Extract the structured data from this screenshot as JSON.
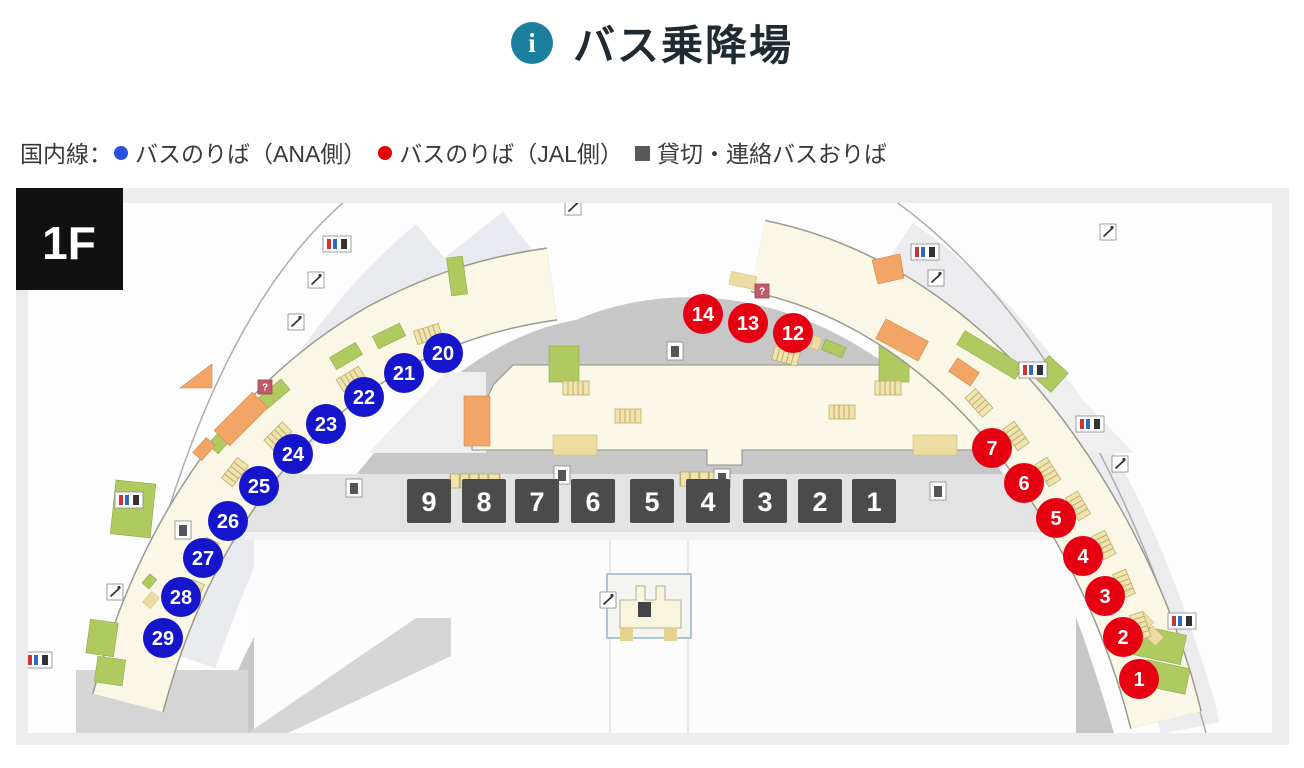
{
  "header": {
    "title": "バス乗降場",
    "icon_glyph": "i",
    "icon_color": "#1A7F9D",
    "title_color": "#1F2B33"
  },
  "legend": {
    "prefix": "国内線：",
    "items": [
      {
        "label": "バスのりば（ANA側）",
        "marker": "circle",
        "color": "#2B50DF"
      },
      {
        "label": "バスのりば（JAL側）",
        "marker": "circle",
        "color": "#E60000"
      },
      {
        "label": "貸切・連絡バスおりば",
        "marker": "square",
        "color": "#585858"
      }
    ]
  },
  "map": {
    "floor_label": "1F",
    "colors": {
      "ana": "#1515CB",
      "jal": "#E60012",
      "alight": "#4B4B4B"
    },
    "ana_stops": [
      {
        "number": "20",
        "x": 427,
        "y": 165
      },
      {
        "number": "21",
        "x": 388,
        "y": 185
      },
      {
        "number": "22",
        "x": 348,
        "y": 209
      },
      {
        "number": "23",
        "x": 310,
        "y": 236
      },
      {
        "number": "24",
        "x": 277,
        "y": 266
      },
      {
        "number": "25",
        "x": 243,
        "y": 298
      },
      {
        "number": "26",
        "x": 212,
        "y": 333
      },
      {
        "number": "27",
        "x": 187,
        "y": 370
      },
      {
        "number": "28",
        "x": 165,
        "y": 409
      },
      {
        "number": "29",
        "x": 147,
        "y": 450
      }
    ],
    "jal_stops": [
      {
        "number": "14",
        "x": 687,
        "y": 126
      },
      {
        "number": "13",
        "x": 732,
        "y": 135
      },
      {
        "number": "12",
        "x": 777,
        "y": 145
      },
      {
        "number": "7",
        "x": 976,
        "y": 260
      },
      {
        "number": "6",
        "x": 1008,
        "y": 295
      },
      {
        "number": "5",
        "x": 1040,
        "y": 330
      },
      {
        "number": "4",
        "x": 1067,
        "y": 368
      },
      {
        "number": "3",
        "x": 1089,
        "y": 408
      },
      {
        "number": "2",
        "x": 1107,
        "y": 449
      },
      {
        "number": "1",
        "x": 1123,
        "y": 491
      }
    ],
    "alight_stops": [
      {
        "number": "9",
        "x": 413,
        "y": 313
      },
      {
        "number": "8",
        "x": 468,
        "y": 313
      },
      {
        "number": "7",
        "x": 521,
        "y": 313
      },
      {
        "number": "6",
        "x": 577,
        "y": 313
      },
      {
        "number": "5",
        "x": 636,
        "y": 313
      },
      {
        "number": "4",
        "x": 692,
        "y": 313
      },
      {
        "number": "3",
        "x": 749,
        "y": 313
      },
      {
        "number": "2",
        "x": 804,
        "y": 313
      },
      {
        "number": "1",
        "x": 858,
        "y": 313
      }
    ]
  }
}
